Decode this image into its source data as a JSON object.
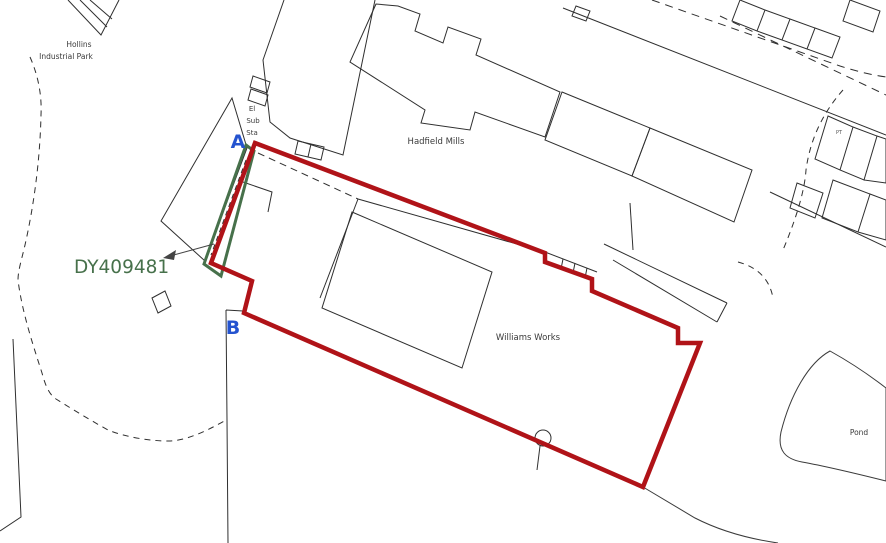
{
  "map": {
    "kind": "title-plan",
    "reference": {
      "label": "DY409481"
    },
    "markers": [
      {
        "label": "A"
      },
      {
        "label": "B"
      }
    ],
    "places": {
      "hollins": [
        "Hollins",
        "Industrial Park"
      ],
      "el_sub_sta": [
        "El",
        "Sub",
        "Sta"
      ],
      "hadfield_mills": "Hadfield Mills",
      "williams_works": "Williams Works",
      "pond": "Pond",
      "pt": "PT"
    },
    "colors": {
      "boundary_red": "#b01318",
      "reference_green": "#47714b",
      "marker_blue": "#2453cf",
      "detail_black": "#2f2f2f",
      "soft_black": "#444444"
    }
  }
}
